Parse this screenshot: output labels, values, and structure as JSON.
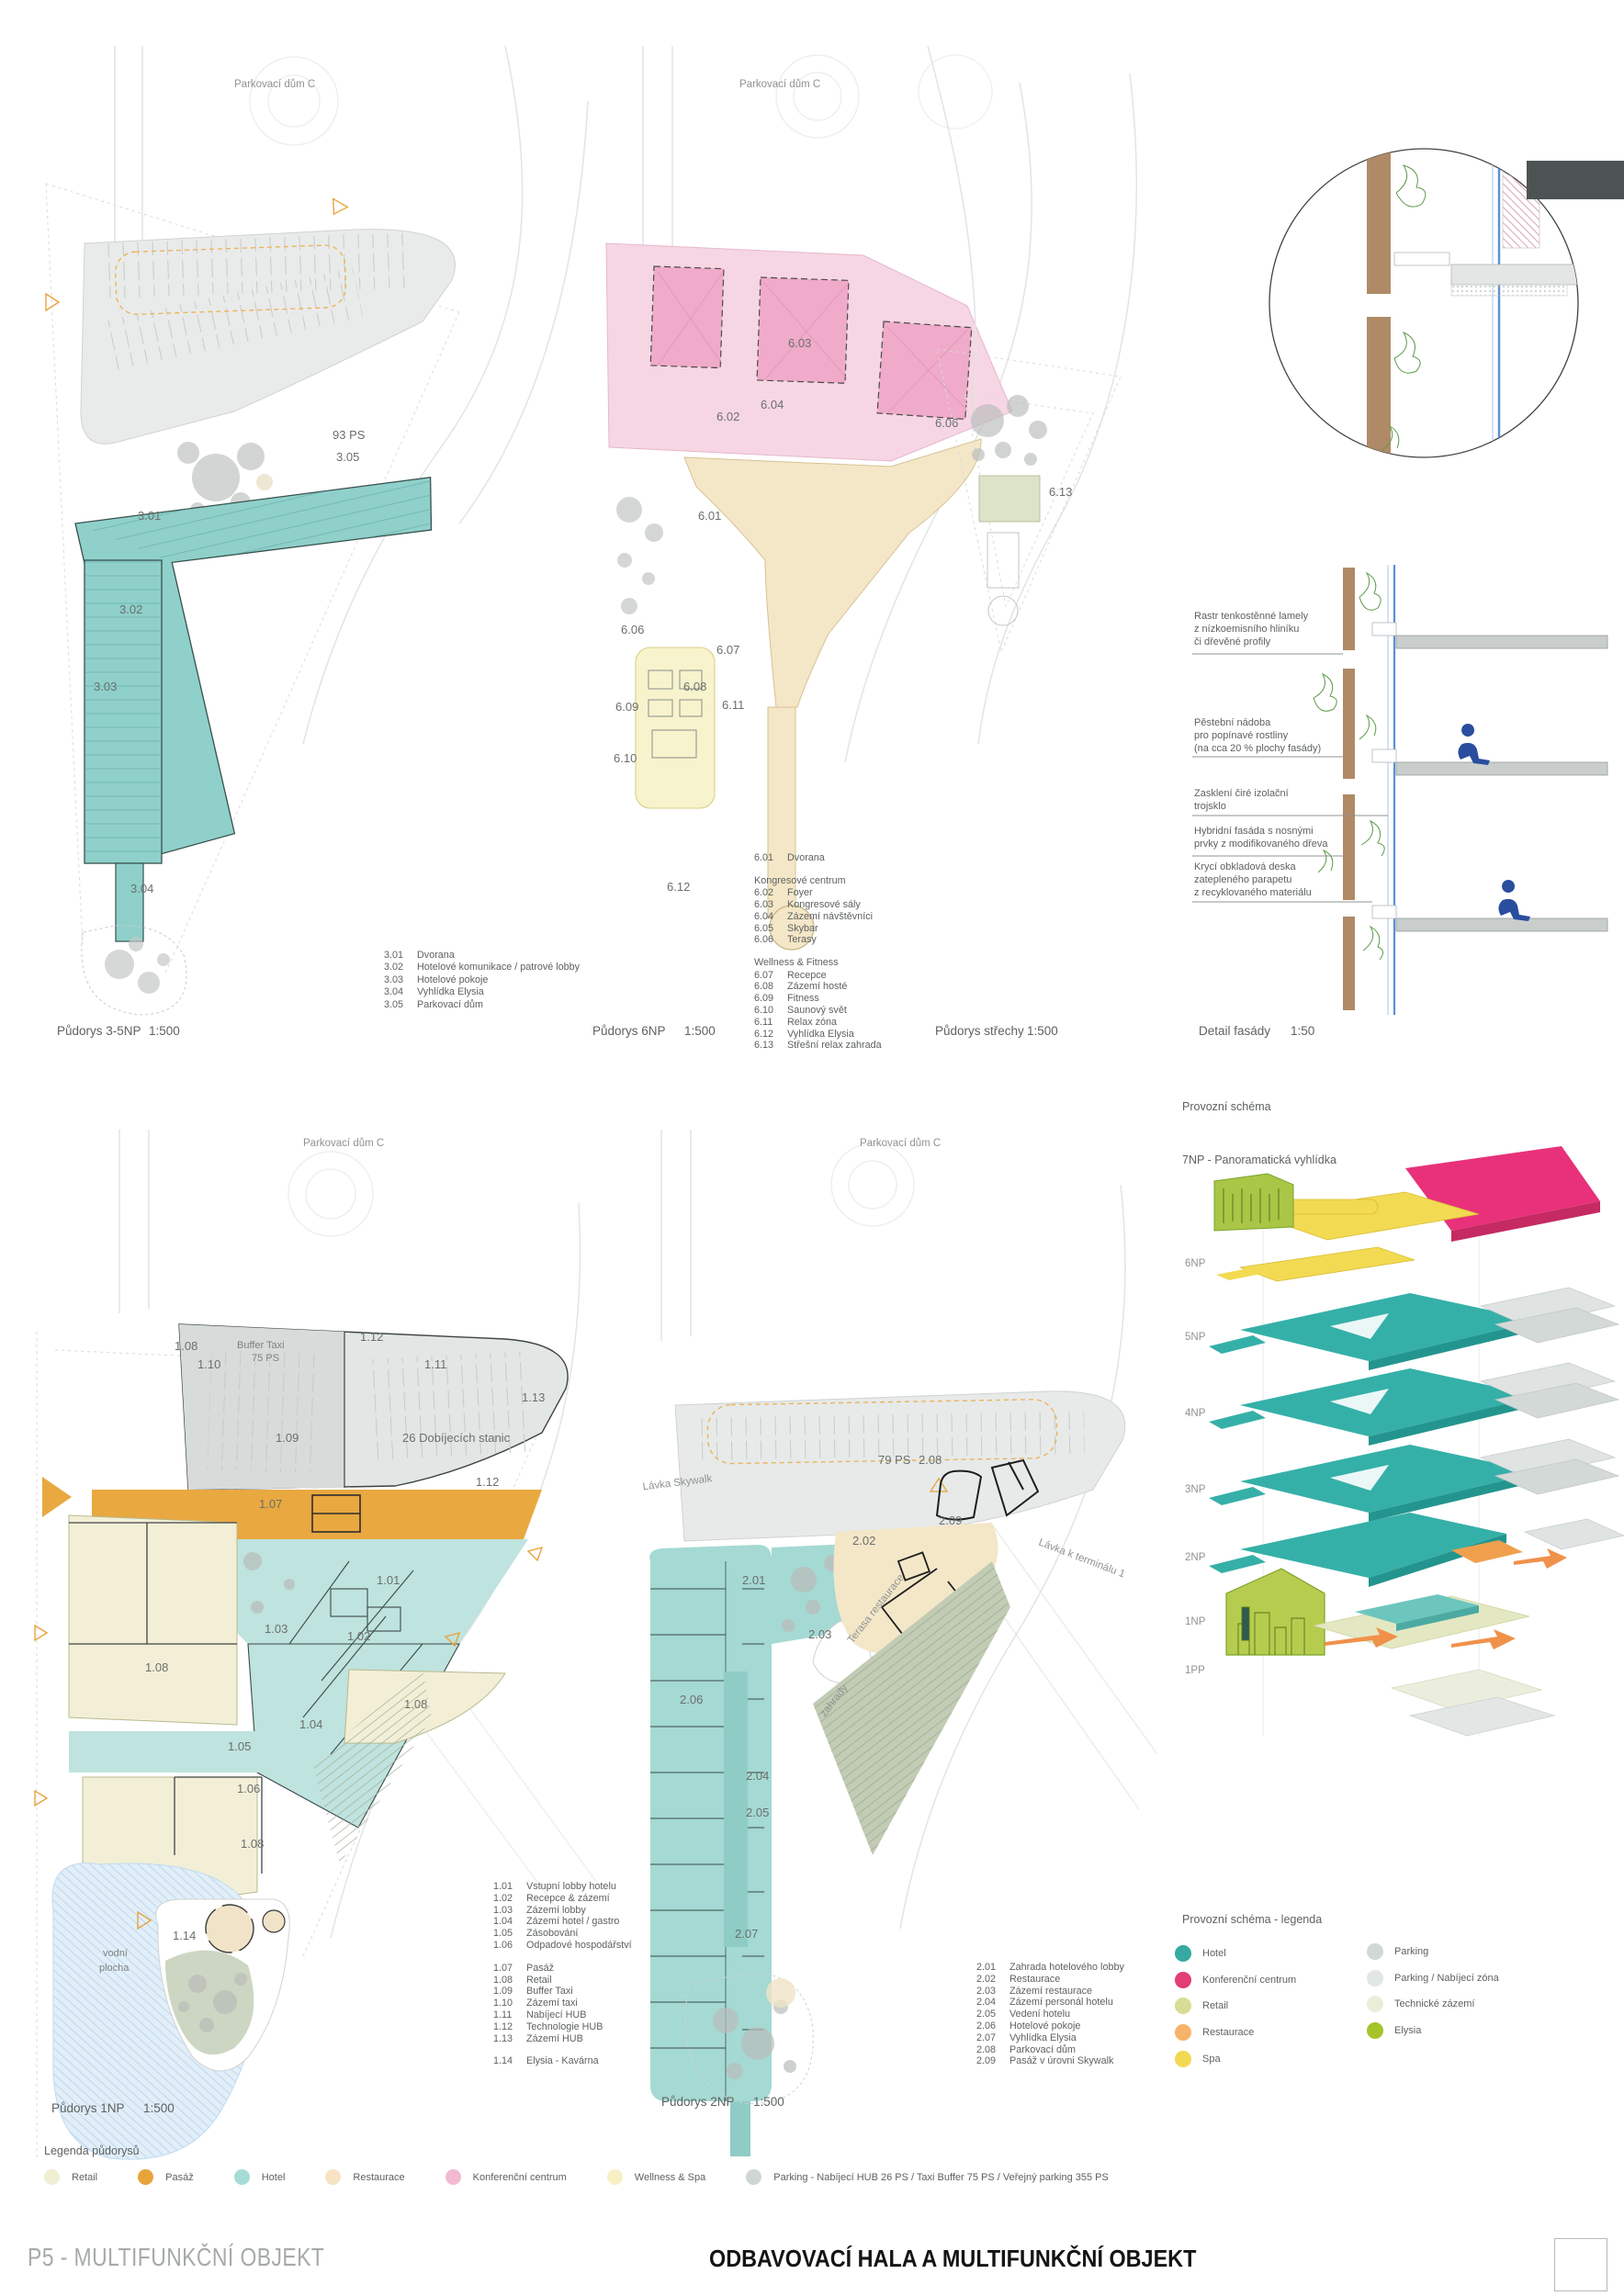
{
  "sheet": {
    "footer_left": "P5 - MULTIFUNKČNÍ OBJEKT",
    "footer_center": "ODBAVOVACÍ HALA A MULTIFUNKČNÍ OBJEKT"
  },
  "captions": {
    "plan35": {
      "label": "Půdorys 3-5NP",
      "scale": "1:500"
    },
    "plan6": {
      "label": "Půdorys 6NP",
      "scale": "1:500"
    },
    "roof": {
      "label": "Půdorys střechy",
      "scale": "1:500"
    },
    "facade": {
      "label": "Detail fasády",
      "scale": "1:50"
    },
    "plan1": {
      "label": "Půdorys 1NP",
      "scale": "1:500"
    },
    "plan2": {
      "label": "Půdorys 2NP",
      "scale": "1:500"
    }
  },
  "plan35": {
    "site_label": "Parkovací dům C",
    "parking_ps": "93 PS",
    "parking_code": "3.05",
    "rooms": {
      "r301": "3.01",
      "r302": "3.02",
      "r303": "3.03",
      "r304": "3.04"
    },
    "legend": [
      {
        "code": "3.01",
        "label": "Dvorana"
      },
      {
        "code": "3.02",
        "label": "Hotelové komunikace / patrové lobby"
      },
      {
        "code": "3.03",
        "label": "Hotelové pokoje"
      },
      {
        "code": "3.04",
        "label": "Vyhlídka Elysia"
      },
      {
        "code": "3.05",
        "label": "Parkovací dům"
      }
    ]
  },
  "plan6": {
    "site_label": "Parkovací dům C",
    "rooms": {
      "r601": "6.01",
      "r602": "6.02",
      "r603": "6.03",
      "r604": "6.04",
      "r606": "6.06",
      "r607": "6.07",
      "r608": "6.08",
      "r609": "6.09",
      "r610": "6.10",
      "r611": "6.11",
      "r612": "6.12"
    },
    "legend_intro": [
      {
        "code": "6.01",
        "label": "Dvorana"
      }
    ],
    "group1_header": "Kongresové centrum",
    "legend_kongres": [
      {
        "code": "6.02",
        "label": "Foyer"
      },
      {
        "code": "6.03",
        "label": "Kongresové sály"
      },
      {
        "code": "6.04",
        "label": "Zázemí návštěvníci"
      },
      {
        "code": "6.05",
        "label": "Skybar"
      },
      {
        "code": "6.06",
        "label": "Terasy"
      }
    ],
    "group2_header": "Wellness & Fitness",
    "legend_wellness": [
      {
        "code": "6.07",
        "label": "Recepce"
      },
      {
        "code": "6.08",
        "label": "Zázemí hosté"
      },
      {
        "code": "6.09",
        "label": "Fitness"
      },
      {
        "code": "6.10",
        "label": "Saunový svět"
      },
      {
        "code": "6.11",
        "label": "Relax zóna"
      },
      {
        "code": "6.12",
        "label": "Vyhlídka Elysia"
      },
      {
        "code": "6.13",
        "label": "Střešní relax zahrada"
      }
    ]
  },
  "roof": {
    "room": "6.13"
  },
  "facade": {
    "annotations": [
      {
        "text": "Rastr tenkostěnné lamely\nz nízkoemisního hliníku\nči dřevěné profily"
      },
      {
        "text": "Pěstební nádoba\npro popínavé rostliny\n(na cca 20 % plochy fasády)"
      },
      {
        "text": "Zasklení čiré izolační\ntrojsklo"
      },
      {
        "text": "Hybridní fasáda s nosnými\nprvky z modifikovaného dřeva"
      },
      {
        "text": "Krycí obkladová deska\nzatepleného parapetu\nz recyklovaného materiálu"
      }
    ]
  },
  "plan1": {
    "site_label": "Parkovací dům C",
    "water_label_1": "vodní",
    "water_label_2": "plocha",
    "buffer_label_1": "Buffer Taxi",
    "buffer_label_2": "75 PS",
    "stations_label": "26 Dobíjecích stanic",
    "rooms": {
      "r101": "1.01",
      "r102": "1.02",
      "r103": "1.03",
      "r104": "1.04",
      "r105": "1.05",
      "r106": "1.06",
      "r107": "1.07",
      "r108": "1.08",
      "r109": "1.09",
      "r110": "1.10",
      "r111": "1.11",
      "r112": "1.12",
      "r113": "1.13",
      "r114": "1.14"
    },
    "legend_a": [
      {
        "code": "1.01",
        "label": "Vstupní lobby hotelu"
      },
      {
        "code": "1.02",
        "label": "Recepce & zázemí"
      },
      {
        "code": "1.03",
        "label": "Zázemí lobby"
      },
      {
        "code": "1.04",
        "label": "Zázemí hotel / gastro"
      },
      {
        "code": "1.05",
        "label": "Zásobování"
      },
      {
        "code": "1.06",
        "label": "Odpadové hospodářství"
      }
    ],
    "legend_b": [
      {
        "code": "1.07",
        "label": "Pasáž"
      },
      {
        "code": "1.08",
        "label": "Retail"
      },
      {
        "code": "1.09",
        "label": "Buffer Taxi"
      },
      {
        "code": "1.10",
        "label": "Zázemí taxi"
      },
      {
        "code": "1.11",
        "label": "Nabíjecí HUB"
      },
      {
        "code": "1.12",
        "label": "Technologie HUB"
      },
      {
        "code": "1.13",
        "label": "Zázemí HUB"
      }
    ],
    "legend_c": [
      {
        "code": "1.14",
        "label": "Elysia - Kavárna"
      }
    ]
  },
  "plan2": {
    "site_label": "Parkovací dům C",
    "ps_label": "79 PS",
    "skywalk_label": "Lávka Skywalk",
    "terminal_label": "Lávka k terminálu 1",
    "terasa_label": "Terasa restaurace",
    "zahrady_label": "zahrady",
    "rooms": {
      "r201": "2.01",
      "r202": "2.02",
      "r203": "2.03",
      "r204": "2.04",
      "r205": "2.05",
      "r206": "2.06",
      "r207": "2.07",
      "r208": "2.08",
      "r209": "2.09"
    },
    "legend": [
      {
        "code": "2.01",
        "label": "Zahrada hotelového lobby"
      },
      {
        "code": "2.02",
        "label": "Restaurace"
      },
      {
        "code": "2.03",
        "label": "Zázemí restaurace"
      },
      {
        "code": "2.04",
        "label": "Zázemí personál hotelu"
      },
      {
        "code": "2.05",
        "label": "Vedení hotelu"
      },
      {
        "code": "2.06",
        "label": "Hotelové pokoje"
      },
      {
        "code": "2.07",
        "label": "Vyhlídka Elysia"
      },
      {
        "code": "2.08",
        "label": "Parkovací dům"
      },
      {
        "code": "2.09",
        "label": "Pasáž v úrovni Skywalk"
      }
    ]
  },
  "scheme": {
    "title": "Provozní schéma",
    "top_label": "7NP - Panoramatická vyhlídka",
    "floors": [
      "6NP",
      "5NP",
      "4NP",
      "3NP",
      "2NP",
      "1NP",
      "1PP"
    ],
    "legend_title": "Provozní schéma - legenda",
    "legend_left": [
      {
        "label": "Hotel",
        "color": "#35a9a2"
      },
      {
        "label": "Konferenční centrum",
        "color": "#e23d74"
      },
      {
        "label": "Retail",
        "color": "#d9dc95"
      },
      {
        "label": "Restaurace",
        "color": "#f6b46b"
      },
      {
        "label": "Spa",
        "color": "#f3d852"
      }
    ],
    "legend_right": [
      {
        "label": "Parking",
        "color": "#d2d8d6"
      },
      {
        "label": "Parking / Nabíjecí zóna",
        "color": "#e2e7e5"
      },
      {
        "label": "Technické zázemí",
        "color": "#ecedd8"
      },
      {
        "label": "Elysia",
        "color": "#a6c32a"
      }
    ]
  },
  "bottom_legend": {
    "title": "Legenda půdorysů",
    "items": [
      {
        "label": "Retail",
        "color": "#f0efd4"
      },
      {
        "label": "Pasáž",
        "color": "#e9a33b"
      },
      {
        "label": "Hotel",
        "color": "#a7dcd6"
      },
      {
        "label": "Restaurace",
        "color": "#f7e3c4"
      },
      {
        "label": "Konferenční centrum",
        "color": "#f2b9d2"
      },
      {
        "label": "Wellness & Spa",
        "color": "#f8f0c5"
      },
      {
        "label": "Parking - Nabíjecí HUB 26 PS / Taxi Buffer 75 PS / Veřejný parking 355 PS",
        "color": "#cfd5d3"
      }
    ]
  }
}
